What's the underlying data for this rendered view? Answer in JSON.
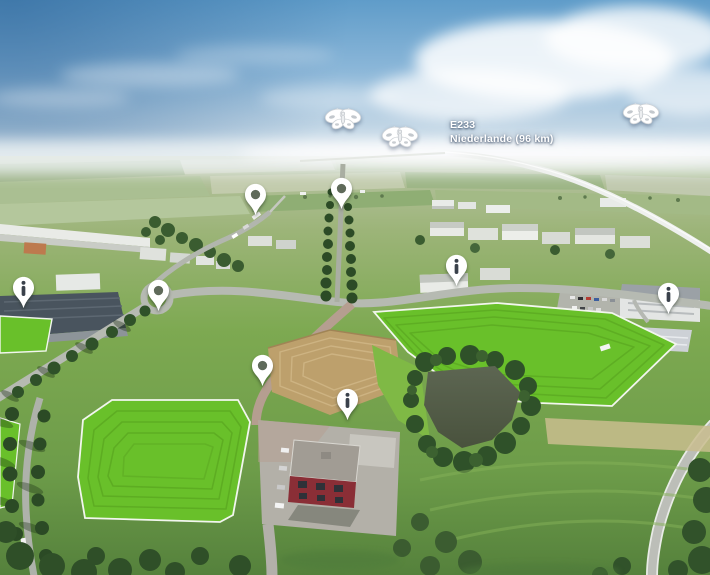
{
  "labels": {
    "route": {
      "line1": "E233",
      "line2": "Niederlande (96 km)"
    }
  },
  "markers": {
    "viewpoint_pins": [
      {
        "id": "viewpoint-pin-1",
        "x": 255,
        "y": 215
      },
      {
        "id": "viewpoint-pin-2",
        "x": 341,
        "y": 209
      },
      {
        "id": "viewpoint-pin-3",
        "x": 158,
        "y": 311
      },
      {
        "id": "viewpoint-pin-4",
        "x": 262,
        "y": 386
      }
    ],
    "info_pins": [
      {
        "id": "info-pin-1",
        "x": 456,
        "y": 286
      },
      {
        "id": "info-pin-2",
        "x": 668,
        "y": 314
      },
      {
        "id": "info-pin-3",
        "x": 23,
        "y": 308
      },
      {
        "id": "info-pin-4",
        "x": 347,
        "y": 420
      }
    ],
    "butterflies": [
      {
        "id": "butterfly-marker-1",
        "x": 343,
        "y": 119
      },
      {
        "id": "butterfly-marker-2",
        "x": 400,
        "y": 137
      },
      {
        "id": "butterfly-marker-3",
        "x": 641,
        "y": 114
      }
    ]
  },
  "colors": {
    "plot_green": "#69c02a",
    "plot_border": "#f2f6ee",
    "pin_fill": "#ffffff",
    "pin_glyph": "#3a414b",
    "sky_top": "#5f9cc9",
    "label_text": "#ffffff"
  }
}
